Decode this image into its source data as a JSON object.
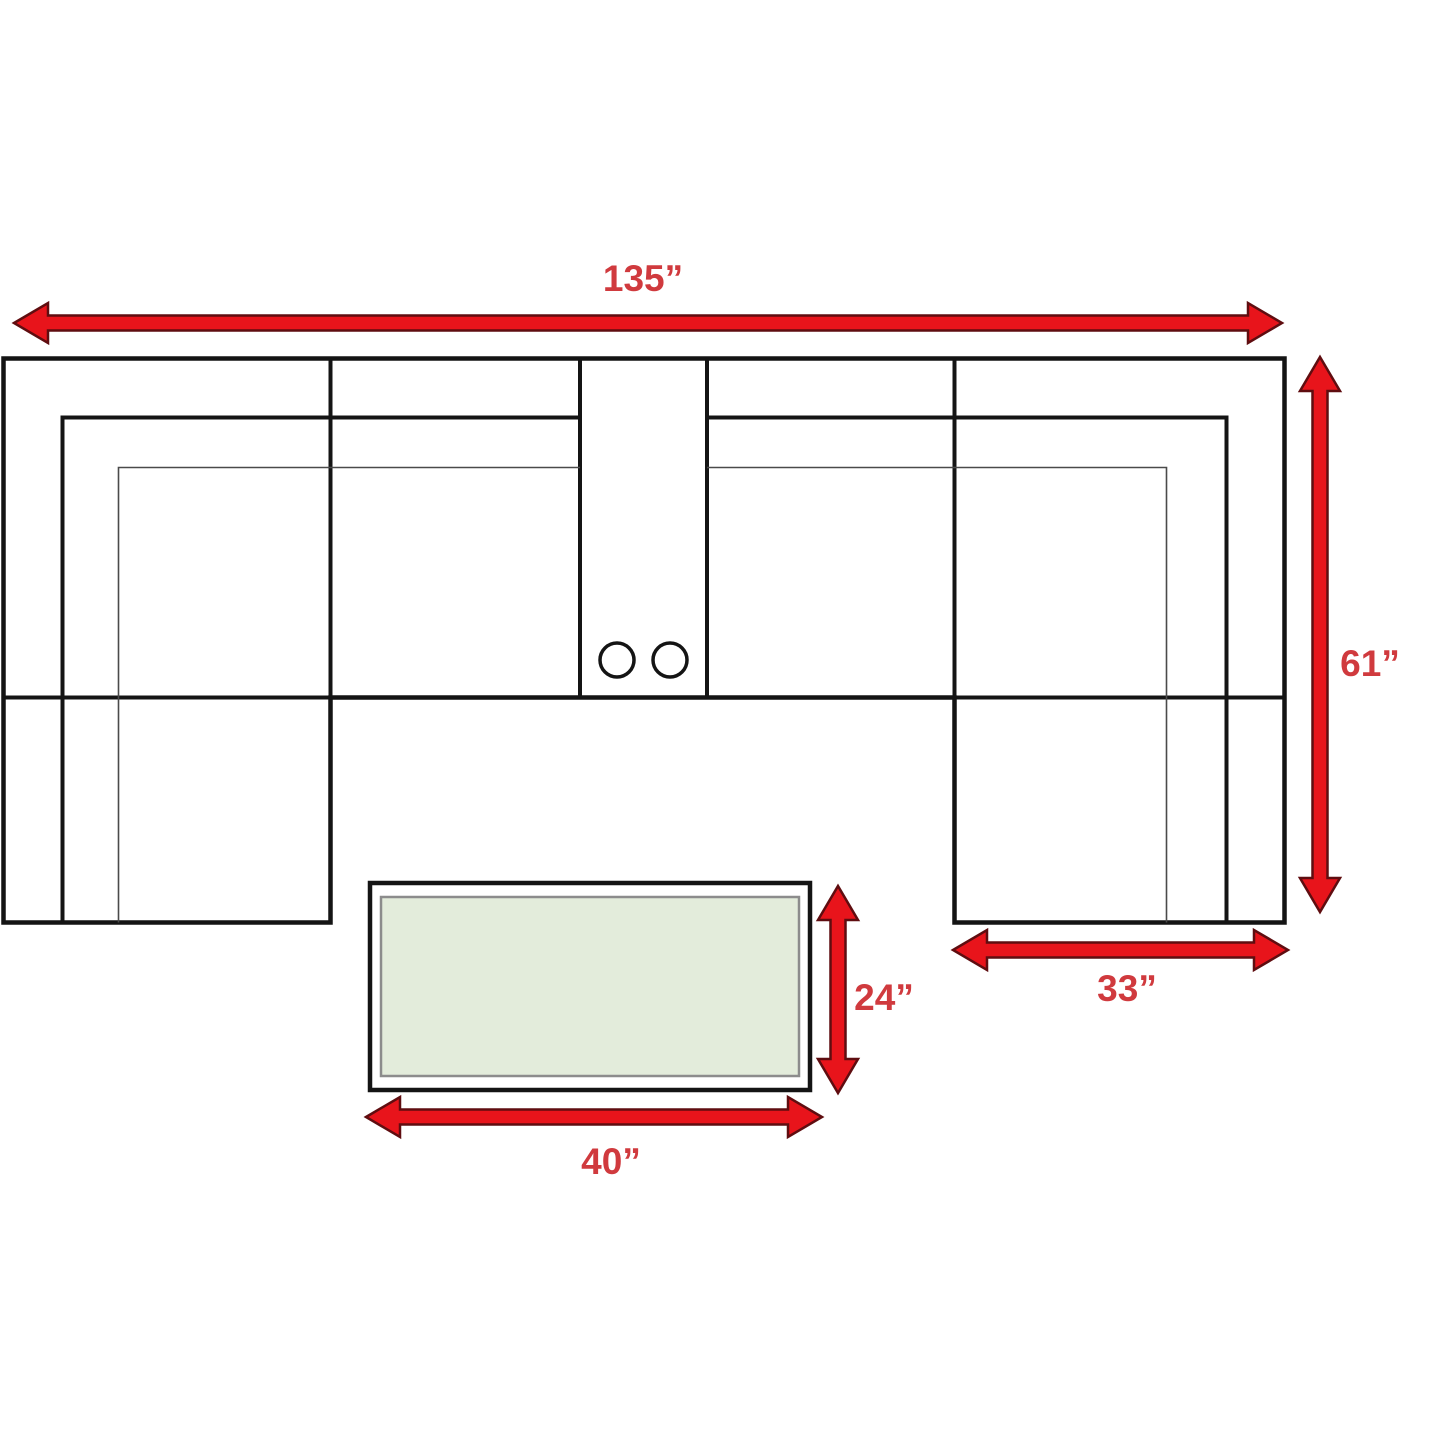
{
  "diagram": {
    "subject": "sectional sofa with chaises, center console and coffee table - top view dimension plan",
    "measurements": {
      "overall_width": "135”",
      "overall_depth": "61”",
      "chaise_width": "33”",
      "table_depth": "24”",
      "table_width": "40”"
    },
    "sofa": {
      "cupholder_count": 2
    },
    "colors": {
      "background": "#ffffff",
      "sofa_line_black": "#141414",
      "seat_line_gray": "#4a4a4a",
      "arrow_fill_red": "#e8141b",
      "arrow_outline_dark_red": "#5f0d10",
      "label_text_red": "#d03a3e",
      "table_top_green": "#e3ecdb",
      "table_inner_border_gray": "#8c8c8c"
    }
  }
}
